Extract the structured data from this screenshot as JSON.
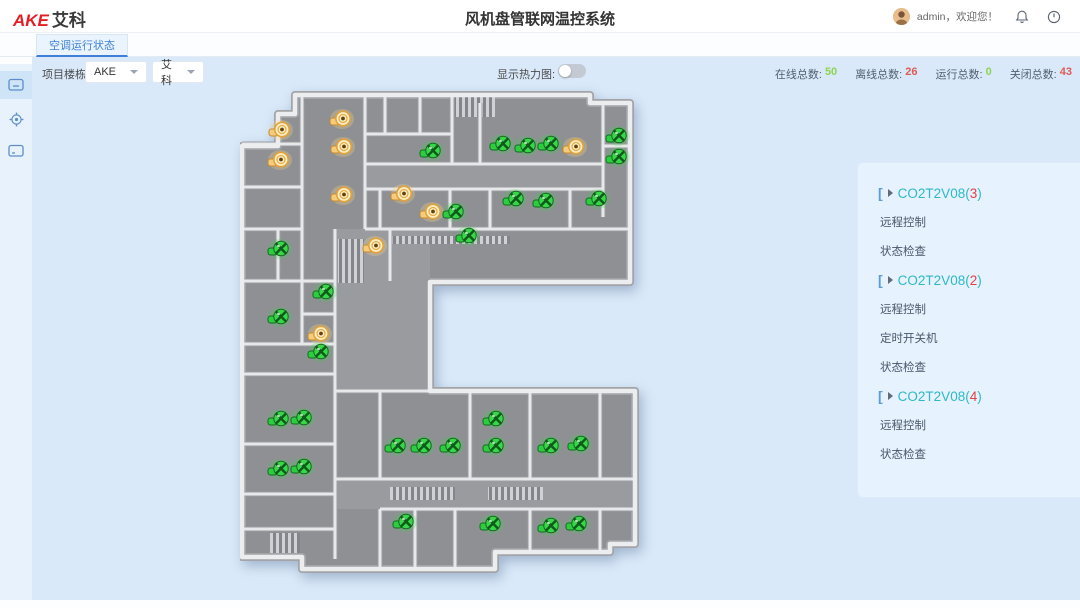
{
  "header": {
    "logo_en": "AKE",
    "logo_cn": "艾科",
    "title": "风机盘管联网温控系统",
    "username": "admin，欢迎您！"
  },
  "tabs": {
    "active": "空调运行状态"
  },
  "sidebar": {
    "items": [
      {
        "icon": "dashboard-grid-icon"
      },
      {
        "icon": "monitor-icon",
        "selected": true
      },
      {
        "icon": "gear-icon"
      },
      {
        "icon": "console-icon"
      }
    ]
  },
  "filters": {
    "label": "项目楼栋:",
    "building_value": "AKE",
    "area_value": "艾科"
  },
  "heatmap": {
    "label": "显示热力图:",
    "enabled": false
  },
  "stats": [
    {
      "label": "在线总数:",
      "value": "50",
      "color": "#8fd34f"
    },
    {
      "label": "离线总数:",
      "value": "26",
      "color": "#e05a55"
    },
    {
      "label": "运行总数:",
      "value": "0",
      "color": "#8fd34f"
    },
    {
      "label": "关闭总数:",
      "value": "43",
      "color": "#e05a55"
    }
  ],
  "device_panel": {
    "groups": [
      {
        "name": "CO2T2V08",
        "count": "3",
        "items": [
          "远程控制",
          "状态检查"
        ]
      },
      {
        "name": "CO2T2V08",
        "count": "2",
        "items": [
          "远程控制",
          "定时开关机",
          "状态检查"
        ]
      },
      {
        "name": "CO2T2V08",
        "count": "4",
        "items": [
          "远程控制",
          "状态检查"
        ]
      }
    ]
  },
  "floorplan": {
    "status_colors": {
      "running": "#3ecf4b",
      "warning": "#f3c36a"
    },
    "fans": [
      {
        "x": 41,
        "y": 41,
        "status": "warning"
      },
      {
        "x": 102,
        "y": 30,
        "status": "warning"
      },
      {
        "x": 103,
        "y": 58,
        "status": "warning"
      },
      {
        "x": 40,
        "y": 71,
        "status": "warning"
      },
      {
        "x": 103,
        "y": 106,
        "status": "warning"
      },
      {
        "x": 163,
        "y": 105,
        "status": "warning"
      },
      {
        "x": 192,
        "y": 123,
        "status": "warning"
      },
      {
        "x": 135,
        "y": 157,
        "status": "warning"
      },
      {
        "x": 80,
        "y": 245,
        "status": "warning"
      },
      {
        "x": 335,
        "y": 58,
        "status": "warning"
      },
      {
        "x": 192,
        "y": 62,
        "status": "running"
      },
      {
        "x": 262,
        "y": 55,
        "status": "running"
      },
      {
        "x": 287,
        "y": 57,
        "status": "running"
      },
      {
        "x": 310,
        "y": 55,
        "status": "running"
      },
      {
        "x": 378,
        "y": 47,
        "status": "running"
      },
      {
        "x": 378,
        "y": 68,
        "status": "running"
      },
      {
        "x": 275,
        "y": 110,
        "status": "running"
      },
      {
        "x": 305,
        "y": 112,
        "status": "running"
      },
      {
        "x": 358,
        "y": 110,
        "status": "running"
      },
      {
        "x": 215,
        "y": 123,
        "status": "running"
      },
      {
        "x": 228,
        "y": 147,
        "status": "running"
      },
      {
        "x": 40,
        "y": 160,
        "status": "running"
      },
      {
        "x": 85,
        "y": 203,
        "status": "running"
      },
      {
        "x": 40,
        "y": 228,
        "status": "running"
      },
      {
        "x": 80,
        "y": 263,
        "status": "running"
      },
      {
        "x": 40,
        "y": 330,
        "status": "running"
      },
      {
        "x": 63,
        "y": 329,
        "status": "running"
      },
      {
        "x": 40,
        "y": 380,
        "status": "running"
      },
      {
        "x": 63,
        "y": 378,
        "status": "running"
      },
      {
        "x": 157,
        "y": 357,
        "status": "running"
      },
      {
        "x": 183,
        "y": 357,
        "status": "running"
      },
      {
        "x": 212,
        "y": 357,
        "status": "running"
      },
      {
        "x": 255,
        "y": 330,
        "status": "running"
      },
      {
        "x": 255,
        "y": 357,
        "status": "running"
      },
      {
        "x": 310,
        "y": 357,
        "status": "running"
      },
      {
        "x": 340,
        "y": 355,
        "status": "running"
      },
      {
        "x": 165,
        "y": 433,
        "status": "running"
      },
      {
        "x": 252,
        "y": 435,
        "status": "running"
      },
      {
        "x": 310,
        "y": 437,
        "status": "running"
      },
      {
        "x": 338,
        "y": 435,
        "status": "running"
      }
    ]
  }
}
